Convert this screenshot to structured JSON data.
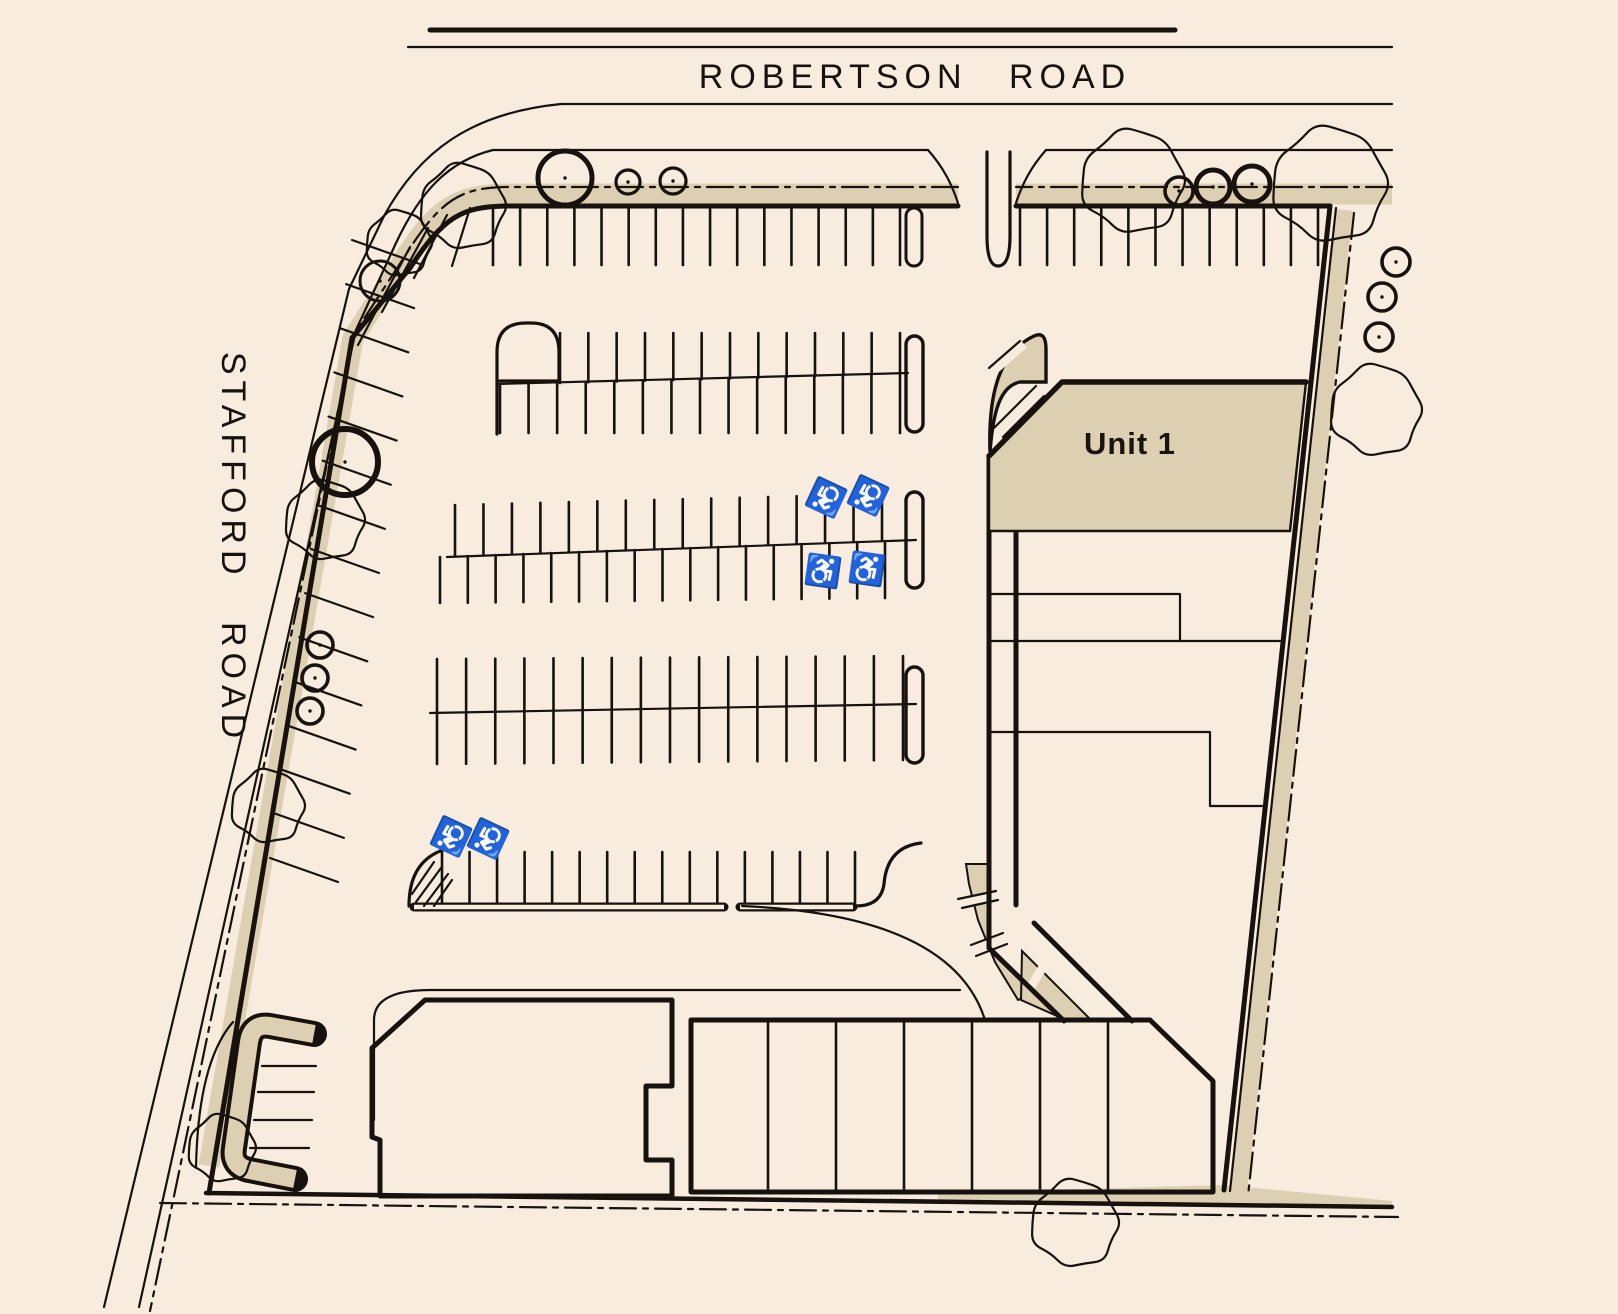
{
  "page": {
    "background": "#f8ecdf",
    "surface_beige": "#dccfb2",
    "line_color": "#17120d"
  },
  "labels": {
    "robertson_road": "ROBERTSON ROAD",
    "stafford_road": "STAFFORD ROAD",
    "unit_1": "Unit 1"
  },
  "icons": {
    "wheelchair_symbol": "♿",
    "tree_icon": "circle-tree",
    "shrub_icon": "deciduous-tree-outline"
  }
}
